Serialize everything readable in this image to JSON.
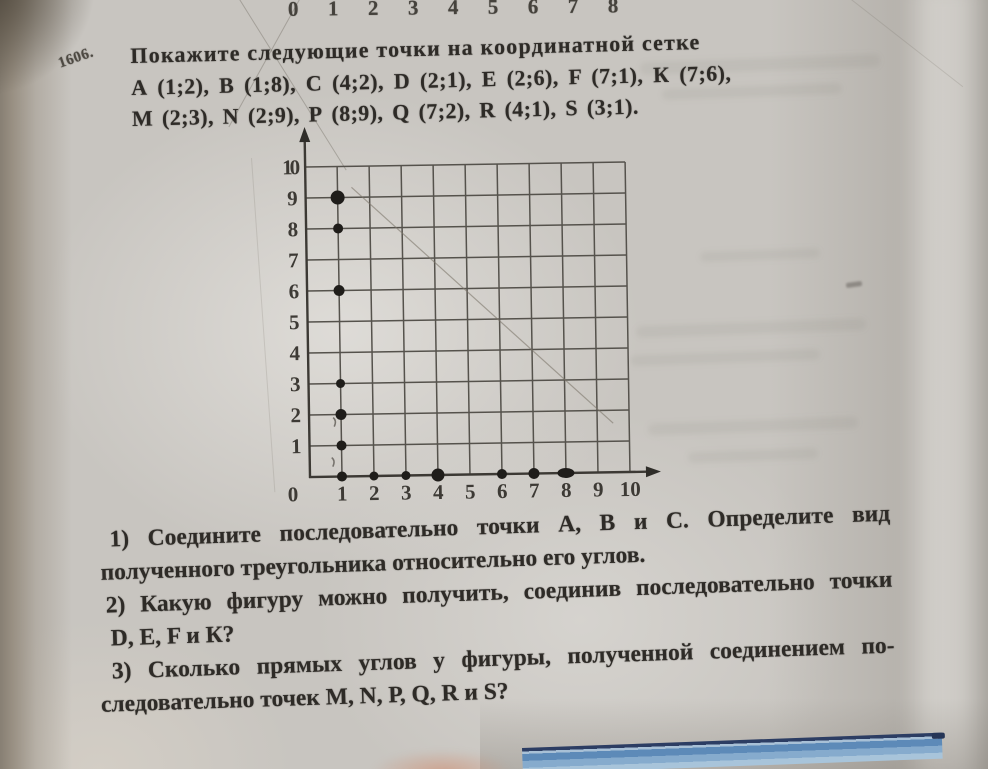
{
  "photo": {
    "description": "photo of Russian math textbook page, problem 1606 with coordinate grid",
    "paper_color": "#c8c5c0",
    "accent_blue_dark": "#2c3d63",
    "accent_blue_light": "#86abcd"
  },
  "top_ruler": {
    "numbers": [
      "0",
      "1",
      "2",
      "3",
      "4",
      "5",
      "6",
      "7",
      "8"
    ]
  },
  "problem": {
    "number": "1606.",
    "statement": "Покажите следующие точки на координатной сетке",
    "points_line1": "А (1;2),  В (1;8),  С (4;2),  D (2;1),  Е (2;6),  F (7;1),  К (7;6),",
    "points_line2": "М (2;3), N (2;9), Р (8;9), Q (7;2), R (4;1), S (3;1)."
  },
  "questions": {
    "q1_line1": "1) Соедините последовательно точки А, В и С.  Определите вид",
    "q1_line2": "полученного треугольника относительно его углов.",
    "q2_line1": "2) Какую фигуру можно получить, соединив последовательно точки",
    "q2_line2": "D, E, F и К?",
    "q3_line1": "3) Сколько прямых углов у фигуры, полученной соединением по-",
    "q3_line2": "следовательно точек М, N, Р, Q, R и S?"
  },
  "chart_data": {
    "type": "scatter",
    "title": "",
    "xlabel": "",
    "ylabel": "",
    "xlim": [
      0,
      10
    ],
    "ylim": [
      0,
      10
    ],
    "grid": true,
    "x_ticks": [
      0,
      1,
      2,
      3,
      4,
      5,
      6,
      7,
      8,
      9,
      10
    ],
    "y_ticks": [
      0,
      1,
      2,
      3,
      4,
      5,
      6,
      7,
      8,
      9,
      10
    ],
    "listed_points": [
      {
        "label": "A",
        "x": 1,
        "y": 2
      },
      {
        "label": "B",
        "x": 1,
        "y": 8
      },
      {
        "label": "C",
        "x": 4,
        "y": 2
      },
      {
        "label": "D",
        "x": 2,
        "y": 1
      },
      {
        "label": "E",
        "x": 2,
        "y": 6
      },
      {
        "label": "F",
        "x": 7,
        "y": 1
      },
      {
        "label": "K",
        "x": 7,
        "y": 6
      },
      {
        "label": "M",
        "x": 2,
        "y": 3
      },
      {
        "label": "N",
        "x": 2,
        "y": 9
      },
      {
        "label": "P",
        "x": 8,
        "y": 9
      },
      {
        "label": "Q",
        "x": 7,
        "y": 2
      },
      {
        "label": "R",
        "x": 4,
        "y": 1
      },
      {
        "label": "S",
        "x": 3,
        "y": 1
      }
    ],
    "plotted_dots": [
      {
        "x": 1,
        "y": 9,
        "r": 7
      },
      {
        "x": 1,
        "y": 8,
        "r": 5
      },
      {
        "x": 1,
        "y": 6,
        "r": 5.5
      },
      {
        "x": 1,
        "y": 3,
        "r": 4.5
      },
      {
        "x": 1,
        "y": 2,
        "r": 5.5
      },
      {
        "x": 1,
        "y": 1,
        "r": 5
      },
      {
        "x": 1,
        "y": 0,
        "r": 5
      },
      {
        "x": 2,
        "y": 0,
        "r": 4.5
      },
      {
        "x": 3,
        "y": 0,
        "r": 4.5
      },
      {
        "x": 4,
        "y": 0,
        "r": 6.5
      },
      {
        "x": 6,
        "y": 0,
        "r": 5
      },
      {
        "x": 7,
        "y": 0,
        "r": 5.5
      },
      {
        "x": 8,
        "y": 0,
        "r": 6,
        "rx": 8.5,
        "ry": 5
      }
    ]
  }
}
